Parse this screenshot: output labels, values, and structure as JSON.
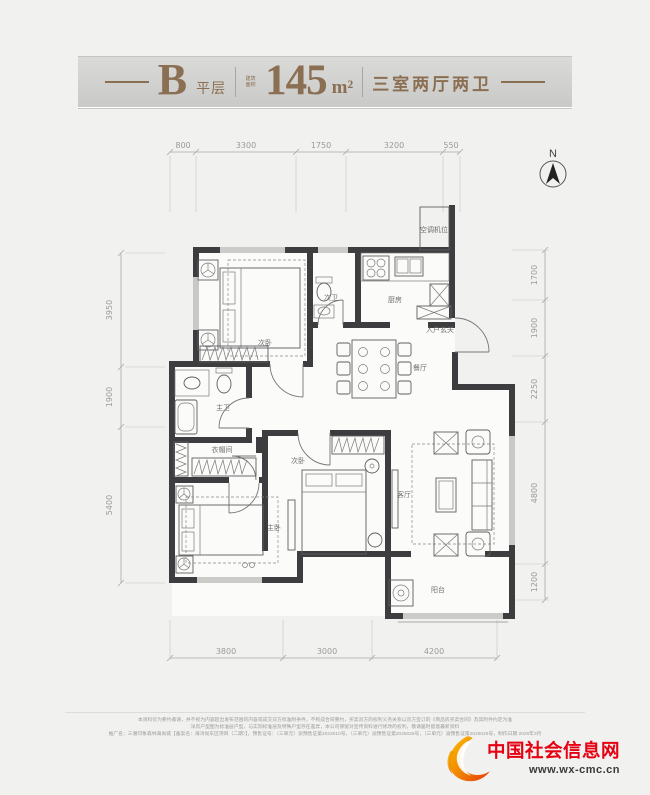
{
  "header": {
    "dash": "—",
    "plan_letter": "B",
    "plan_suffix": "平层",
    "area_prefix": "建筑面积",
    "area_value": "145",
    "area_unit": "m²",
    "layout_desc": "三室两厅两卫"
  },
  "compass": {
    "label": "N"
  },
  "dims": {
    "top": [
      "800",
      "3300",
      "1750",
      "3200",
      "550"
    ],
    "left": [
      "3950",
      "1900",
      "5400"
    ],
    "right": [
      "1700",
      "1900",
      "2250",
      "4800",
      "1200"
    ],
    "bottom": [
      "3800",
      "3000",
      "4200"
    ]
  },
  "rooms": {
    "bedroom2": "次卧",
    "bath2": "次卫",
    "kitchen": "厨房",
    "foyer": "入户玄关",
    "dining": "餐厅",
    "bath1": "主卫",
    "closet": "衣帽间",
    "bedroom3": "次卧",
    "master": "主卧",
    "living": "客厅",
    "balcony": "阳台",
    "ac": "空调机位"
  },
  "footer": {
    "disclaimer1": "本资料仅为要约邀请，并不视为内容超出发布范围的内容或成交双方标准附条件，不构成合同要约，买卖双方的权利义务关系以双方签订的《商品房买卖合同》及其附件约定为准",
    "disclaimer2": "洋房户型图为标准层户型，与实际标准层及特殊户型存在差异，本公司保留对宣传资料进行修改的权利，敬请届时留意最新资料",
    "disclaimer3": "推广名：三湘印象森林海尚城【备案名：海湾尚东区项目（二期）】，预售证号：（三单元）渝预售证第2023010号，（三单元）渝预售证第2025025号，（三单元）渝预售证第2025026号，制作日期 2026年3月"
  },
  "logo": {
    "site_name": "中国社会信息网",
    "site_url": "www.wx-cmc.cn"
  },
  "colors": {
    "accent_bronze": "#8b6f52",
    "wall": "#3d3d3f",
    "logo_red": "#e60012",
    "page_bg": "#f1f1ef"
  }
}
